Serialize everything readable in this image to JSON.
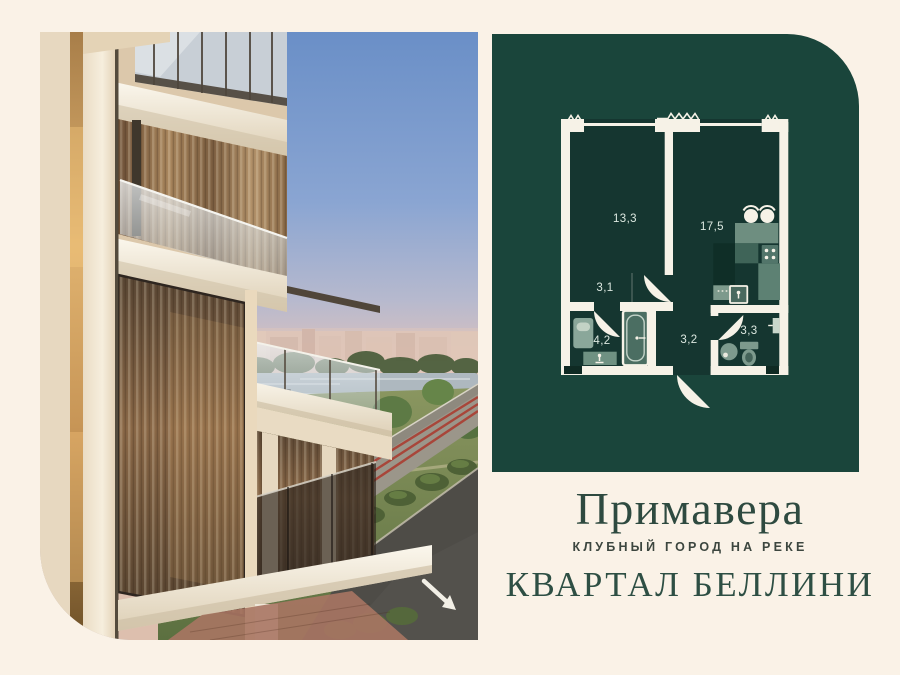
{
  "brand": {
    "name": "Примавера",
    "tagline": "КЛУБНЫЙ ГОРОД НА РЕКЕ",
    "quarter": "КВАРТАЛ БЕЛЛИНИ"
  },
  "floorplan": {
    "rooms": [
      {
        "id": "room-13-3",
        "area": "13,3"
      },
      {
        "id": "kitchen-17-5",
        "area": "17,5"
      },
      {
        "id": "hall-3-1",
        "area": "3,1"
      },
      {
        "id": "bathroom-4-2",
        "area": "4,2"
      },
      {
        "id": "corridor-3-2",
        "area": "3,2"
      },
      {
        "id": "wc-3-3",
        "area": "3,3"
      }
    ]
  },
  "photo": {
    "description": "Beige residential tower with glass balconies overlooking a river, park, boulevard and road with a white direction arrow"
  },
  "colors": {
    "page_background": "#faf2e7",
    "panel_green": "#1a453b",
    "plan_floor": "#153630",
    "wall_white": "#f6f2e7",
    "fixture_green": "#7d9a8c",
    "brand_text": "#2e4a40",
    "tagline_text": "#3c463f"
  }
}
